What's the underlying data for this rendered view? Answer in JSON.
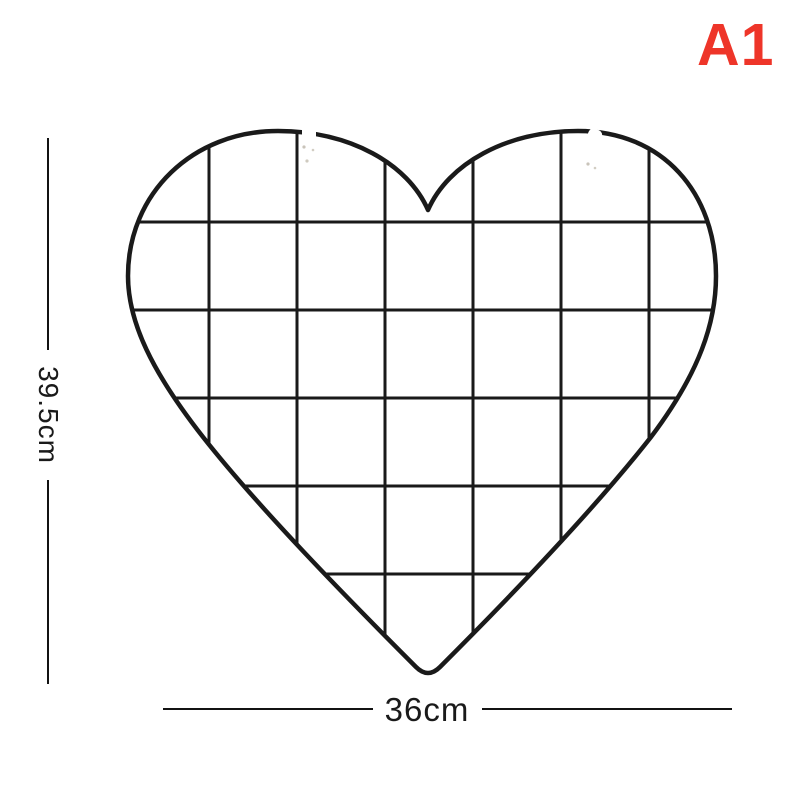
{
  "background_color": "#ffffff",
  "variant_badge": {
    "label": "A1",
    "color": "#ee3529"
  },
  "product_photo": {
    "description": "black heart-shaped wire grid photo wall panel with two small white hanging clips at the top of the lobes",
    "wire_color": "#1a1a1a"
  },
  "dimensions": {
    "height_label": "39.5cm",
    "width_label": "36cm",
    "line_color": "#131313",
    "text_color": "#1a1a1a"
  }
}
